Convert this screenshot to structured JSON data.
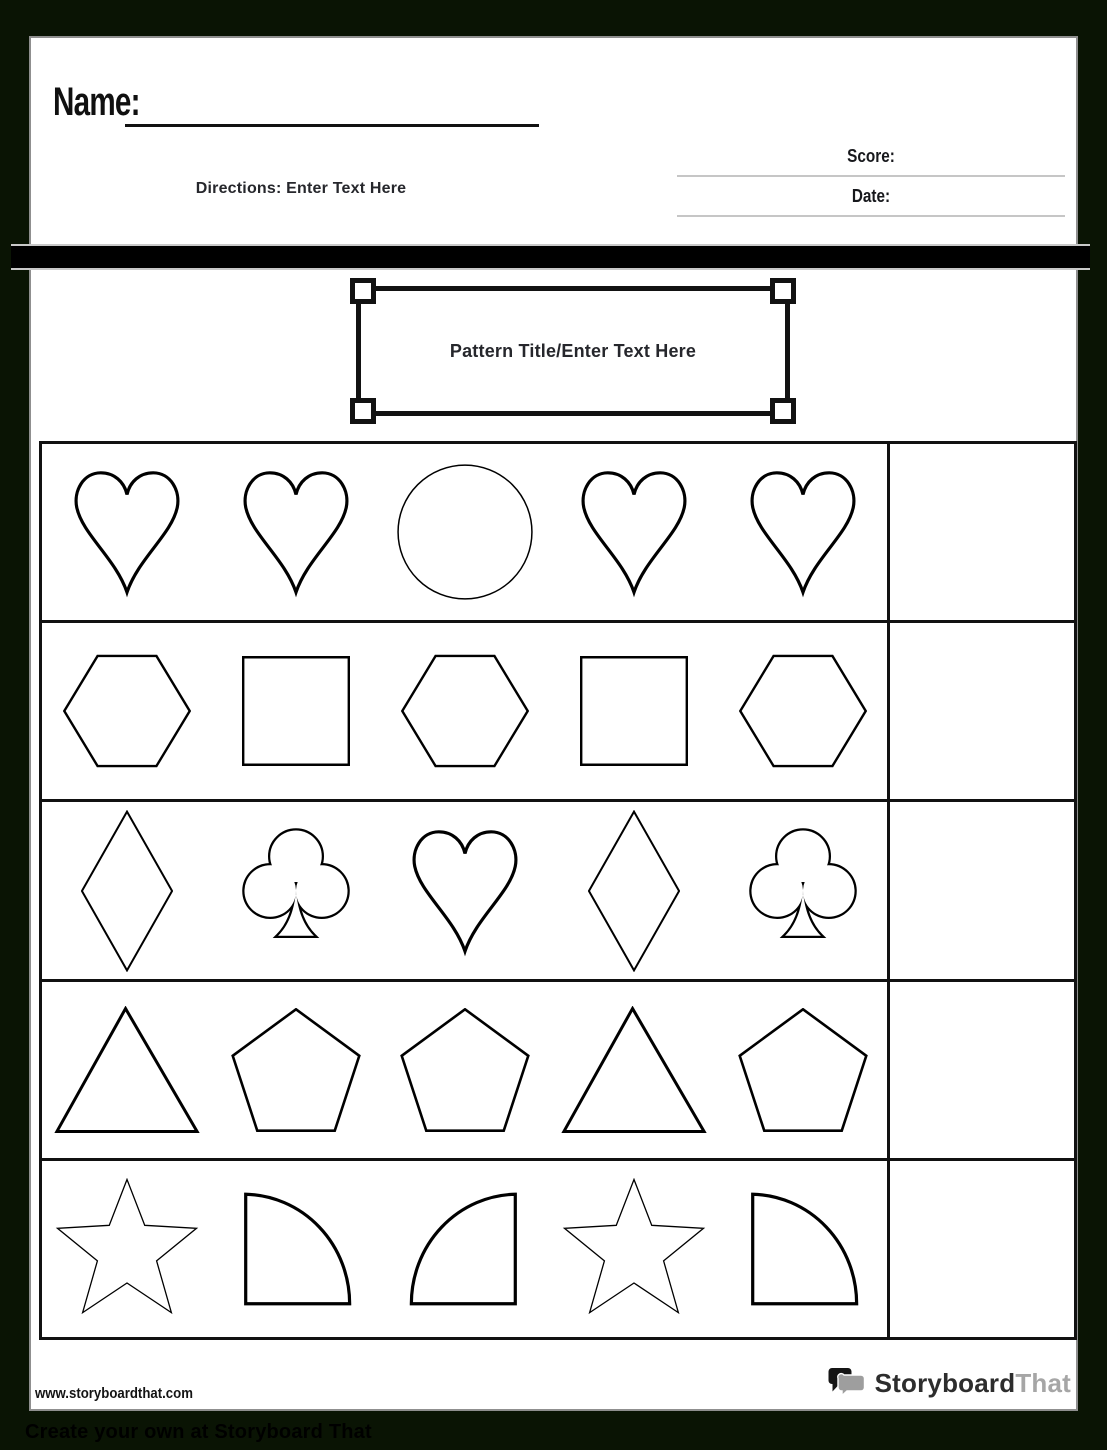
{
  "header": {
    "name_label": "Name:",
    "directions": "Directions: Enter Text Here",
    "score_label": "Score:",
    "date_label": "Date:",
    "pattern_title": "Pattern Title/Enter Text Here"
  },
  "worksheet": {
    "rows": [
      {
        "shapes": [
          "heart",
          "heart",
          "circle",
          "heart",
          "heart"
        ]
      },
      {
        "shapes": [
          "hexagon",
          "square",
          "hexagon",
          "square",
          "hexagon"
        ]
      },
      {
        "shapes": [
          "diamond",
          "club",
          "heart",
          "diamond",
          "club"
        ]
      },
      {
        "shapes": [
          "triangle",
          "pentagon",
          "pentagon",
          "triangle",
          "pentagon"
        ]
      },
      {
        "shapes": [
          "star",
          "quarter-circle-left",
          "quarter-circle-right",
          "star",
          "quarter-circle-left"
        ]
      }
    ],
    "answer_column_blank": ""
  },
  "footer": {
    "url": "www.storyboardthat.com",
    "logo_primary": "Storyboard",
    "logo_secondary": "That",
    "band_text": "Create your own at Storyboard That"
  },
  "colors": {
    "canvas_bg": "#0a1404",
    "page_bg": "#ffffff",
    "bar_black": "#000000",
    "rule_gray": "#c6c6c6",
    "ink_dark": "#121212",
    "logo_gray": "#a6a6a6"
  }
}
